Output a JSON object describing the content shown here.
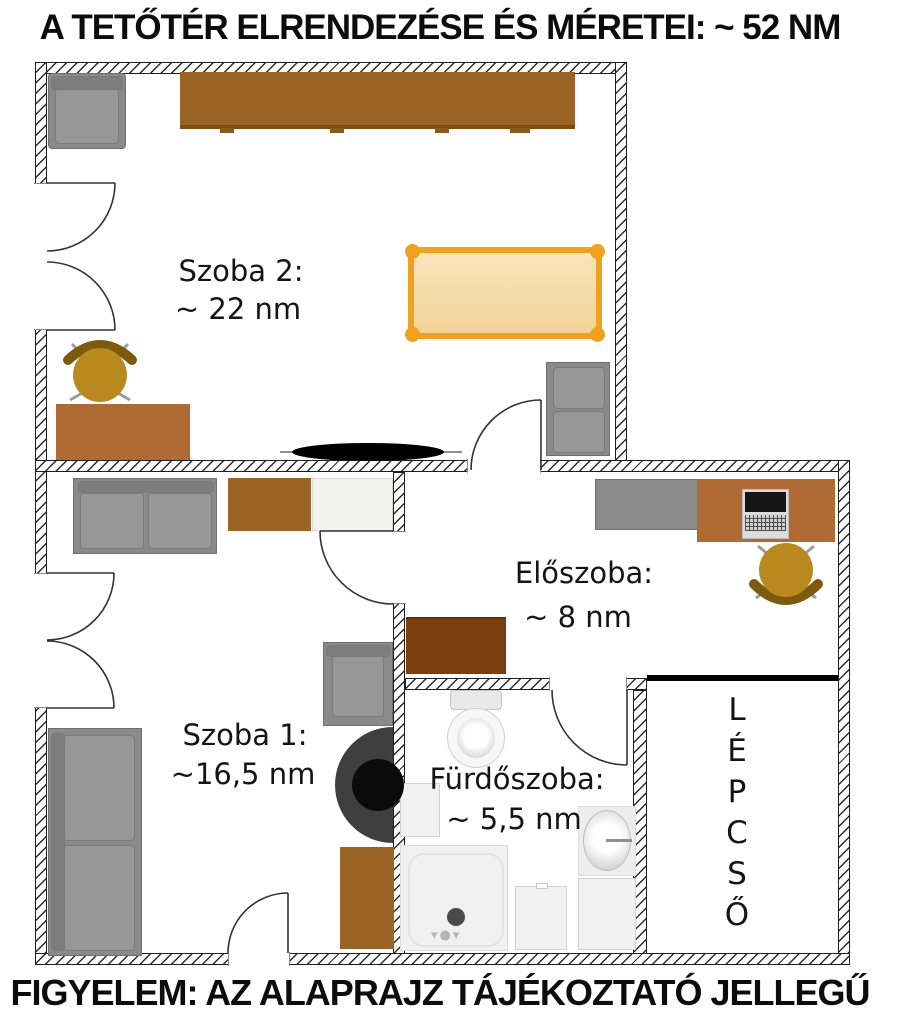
{
  "title": "A TETŐTÉR ELRENDEZÉSE ÉS MÉRETEI: ~ 52 NM",
  "footer": "FIGYELEM: AZ ALAPRAJZ TÁJÉKOZTATÓ JELLEGŰ",
  "rooms": {
    "szoba2": {
      "name": "Szoba 2:",
      "area": "~ 22 nm"
    },
    "szoba1": {
      "name": "Szoba 1:",
      "area": "~16,5 nm"
    },
    "eloszoba": {
      "name": "Előszoba:",
      "area": "~ 8 nm"
    },
    "furdoszoba": {
      "name": "Fürdőszoba:",
      "area": "~ 5,5 nm"
    },
    "lepcso": {
      "name": "LÉPCSŐ",
      "letters": [
        "L",
        "É",
        "P",
        "C",
        "S",
        "Ő"
      ]
    }
  },
  "colors": {
    "wardrobe_brown": "#9a6426",
    "desk_brown": "#b06a33",
    "dark_brown_cabinet": "#7b3f0f",
    "bed_frame_orange": "#f0a11f",
    "bed_fill": "#f6dfae",
    "chair_gold": "#b8891e",
    "furniture_gray": "#8a8a8a",
    "wall_hatch": "#2b2b2b"
  },
  "furniture_icons": [
    "armchair",
    "wardrobe",
    "double-door",
    "bed",
    "loveseat",
    "office-chair",
    "desk",
    "ceiling-fan",
    "sofa",
    "cabinet",
    "speaker",
    "sideboard",
    "laptop",
    "shoe-cabinet",
    "toilet",
    "sink",
    "shower",
    "washing-machine",
    "staircase"
  ]
}
